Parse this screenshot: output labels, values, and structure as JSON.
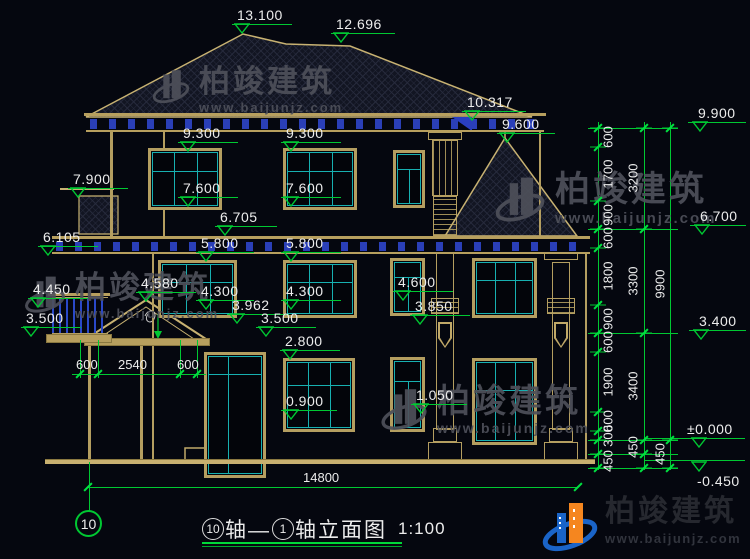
{
  "watermark": {
    "brand": "柏竣建筑",
    "url": "www.baijunjz.com"
  },
  "logo": {
    "brand": "柏竣建筑",
    "url": "www.baijunjz.com"
  },
  "title_block": {
    "bubble_left": "10",
    "text_mid": "轴—",
    "bubble_right": "1",
    "text_tail": "轴立面图",
    "scale": "1:100",
    "axis_bubble": "10"
  },
  "elevation_markers": [
    {
      "label": "13.100",
      "x": 232,
      "y": 24,
      "w": 60
    },
    {
      "label": "12.696",
      "x": 331,
      "y": 33,
      "w": 64
    },
    {
      "label": "10.317",
      "x": 462,
      "y": 111,
      "w": 64
    },
    {
      "label": "9.600",
      "x": 497,
      "y": 133,
      "w": 58
    },
    {
      "label": "9.300",
      "x": 178,
      "y": 142,
      "w": 60
    },
    {
      "label": "9.300",
      "x": 281,
      "y": 142,
      "w": 60
    },
    {
      "label": "7.900",
      "x": 68,
      "y": 188,
      "w": 60
    },
    {
      "label": "7.600",
      "x": 178,
      "y": 197,
      "w": 60
    },
    {
      "label": "7.600",
      "x": 281,
      "y": 197,
      "w": 60
    },
    {
      "label": "6.705",
      "x": 215,
      "y": 226,
      "w": 62
    },
    {
      "label": "6.105",
      "x": 38,
      "y": 246,
      "w": 60
    },
    {
      "label": "5.800",
      "x": 196,
      "y": 252,
      "w": 58
    },
    {
      "label": "5.800",
      "x": 281,
      "y": 252,
      "w": 60
    },
    {
      "label": "4.580",
      "x": 136,
      "y": 292,
      "w": 60
    },
    {
      "label": "4.450",
      "x": 28,
      "y": 298,
      "w": 60
    },
    {
      "label": "4.300",
      "x": 196,
      "y": 300,
      "w": 58
    },
    {
      "label": "4.300",
      "x": 281,
      "y": 300,
      "w": 60
    },
    {
      "label": "3.962",
      "x": 227,
      "y": 314,
      "w": 62
    },
    {
      "label": "3.500",
      "x": 21,
      "y": 327,
      "w": 60
    },
    {
      "label": "3.500",
      "x": 256,
      "y": 327,
      "w": 60
    },
    {
      "label": "2.800",
      "x": 280,
      "y": 350,
      "w": 60
    },
    {
      "label": "4.600",
      "x": 393,
      "y": 291,
      "w": 60
    },
    {
      "label": "3.850",
      "x": 410,
      "y": 315,
      "w": 60
    },
    {
      "label": "1.050",
      "x": 411,
      "y": 404,
      "w": 56
    },
    {
      "label": "0.900",
      "x": 281,
      "y": 410,
      "w": 56
    },
    {
      "label": "9.900",
      "x": 688,
      "y": 122,
      "w": 58,
      "tx": 10,
      "trix": 4
    },
    {
      "label": "6.700",
      "x": 690,
      "y": 225,
      "w": 56,
      "tx": 10,
      "trix": 4
    },
    {
      "label": "3.400",
      "x": 689,
      "y": 330,
      "w": 57,
      "tx": 10,
      "trix": 4
    },
    {
      "label": "±0.000",
      "x": 645,
      "y": 438,
      "w": 100,
      "tx": 42,
      "trix": 46
    },
    {
      "label": "-0.450",
      "x": 645,
      "y": 460,
      "w": 100,
      "tx": 52,
      "trix": 46,
      "below": true
    }
  ],
  "v_chains": [
    {
      "x": 598,
      "y1": 122,
      "y2": 470,
      "lx": 10,
      "ticks": [
        128,
        147,
        201,
        229,
        248,
        305,
        333,
        352,
        412,
        431,
        440,
        454,
        468
      ],
      "labels": [
        {
          "t": "600",
          "y": 137
        },
        {
          "t": "1700",
          "y": 174
        },
        {
          "t": "900",
          "y": 215
        },
        {
          "t": "600",
          "y": 238
        },
        {
          "t": "1800",
          "y": 276
        },
        {
          "t": "900",
          "y": 319
        },
        {
          "t": "600",
          "y": 342
        },
        {
          "t": "1900",
          "y": 382
        },
        {
          "t": "600",
          "y": 421
        },
        {
          "t": "300",
          "y": 436
        },
        {
          "t": "450",
          "y": 461
        }
      ]
    },
    {
      "x": 644,
      "y1": 122,
      "y2": 470,
      "lx": -11,
      "ticks": [
        128,
        229,
        333,
        440,
        454,
        468
      ],
      "labels": [
        {
          "t": "3200",
          "y": 178
        },
        {
          "t": "3300",
          "y": 281
        },
        {
          "t": "3400",
          "y": 386
        },
        {
          "t": "450",
          "y": 447
        }
      ]
    },
    {
      "x": 670,
      "y1": 122,
      "y2": 470,
      "lx": -10,
      "ticks": [
        128,
        440,
        468
      ],
      "labels": [
        {
          "t": "9900",
          "y": 284
        },
        {
          "t": "450",
          "y": 454
        }
      ]
    }
  ],
  "h_dims": [
    {
      "y": 374,
      "x1": 72,
      "x2": 206,
      "ticks": [
        80,
        98,
        180,
        197
      ],
      "labels": [
        {
          "t": "600",
          "x": 76
        },
        {
          "t": "2540",
          "x": 118
        },
        {
          "t": "600",
          "x": 177
        }
      ]
    },
    {
      "y": 487,
      "x1": 88,
      "x2": 578,
      "ticks": [
        88,
        578
      ],
      "labels": [
        {
          "t": "14800",
          "x": 303
        }
      ]
    }
  ]
}
